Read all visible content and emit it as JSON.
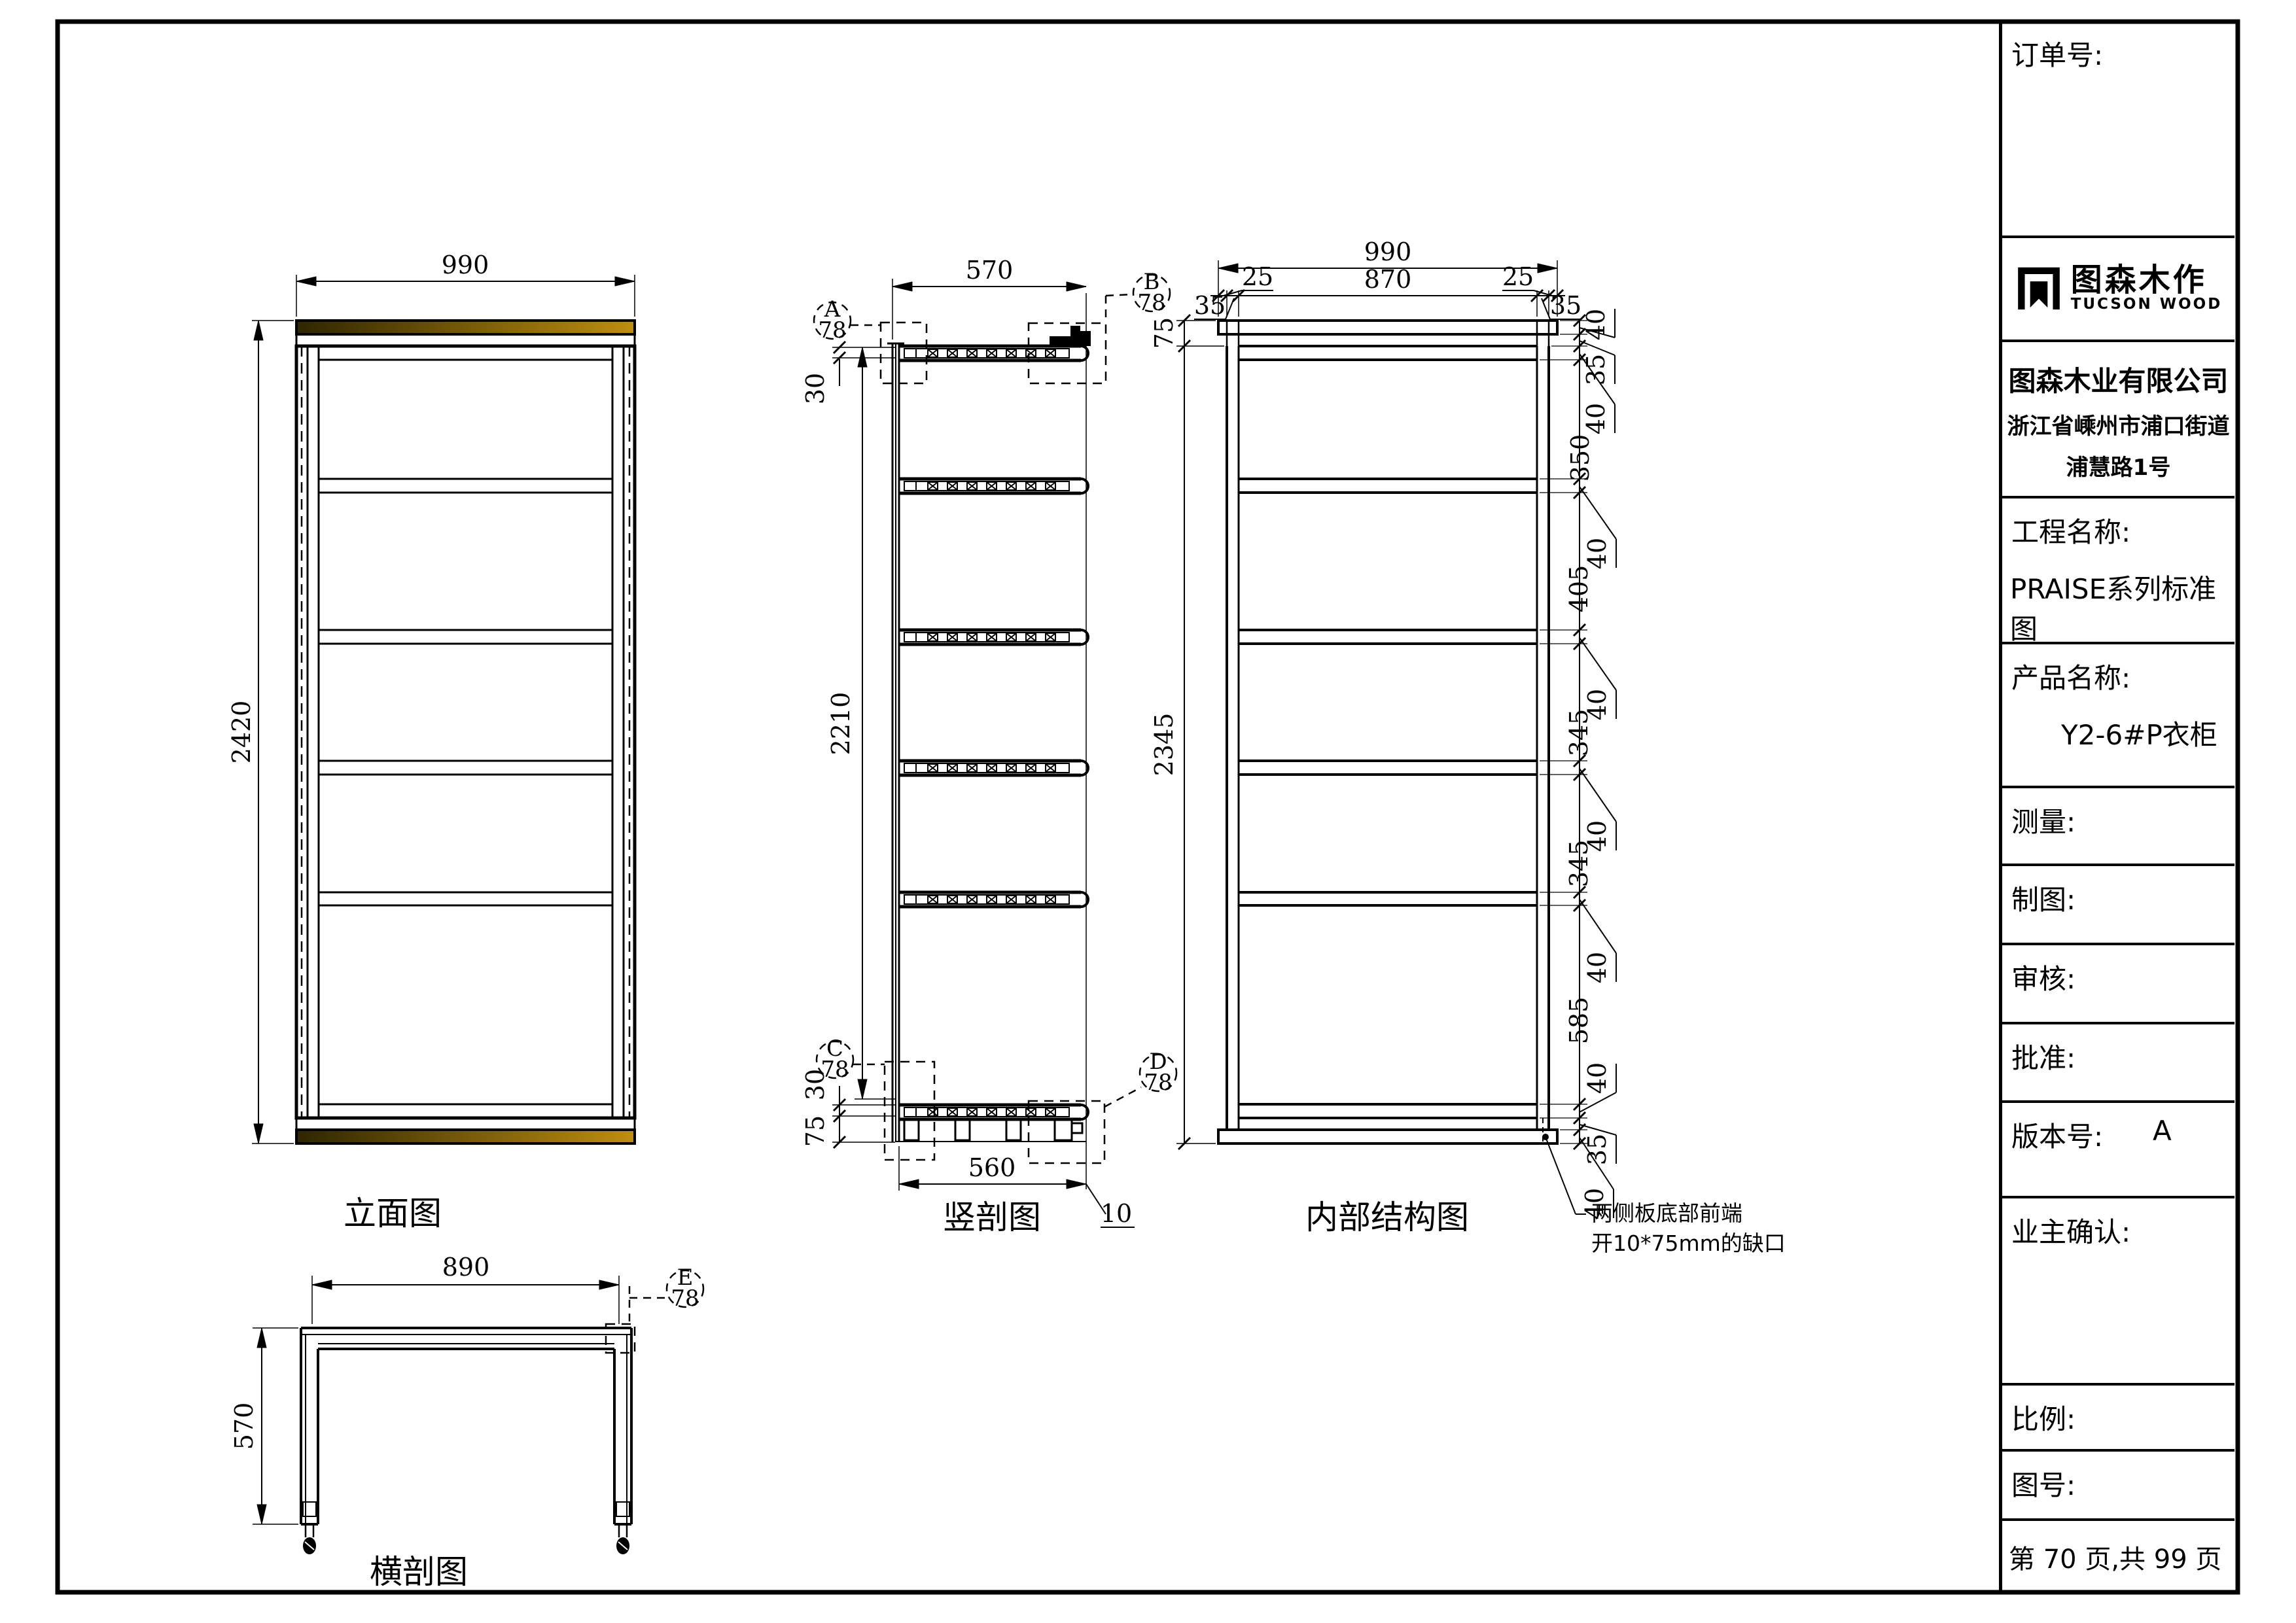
{
  "title_block": {
    "order_label": "订单号:",
    "logo_cn": "图森木作",
    "logo_en": "TUCSON WOOD",
    "company_name": "图森木业有限公司",
    "company_addr1": "浙江省嵊州市浦口街道",
    "company_addr2": "浦慧路1号",
    "project_label": "工程名称:",
    "project_value": "PRAISE系列标准图",
    "product_label": "产品名称:",
    "product_value": "Y2-6#P衣柜",
    "measure_label": "测量:",
    "draft_label": "制图:",
    "review_label": "审核:",
    "approve_label": "批准:",
    "version_label": "版本号:",
    "version_value": "A",
    "owner_label": "业主确认:",
    "scale_label": "比例:",
    "drawing_no_label": "图号:",
    "page_text": "第 70 页,共 99 页"
  },
  "views": {
    "detail_no": "78",
    "elevation": {
      "label": "立面图",
      "width": "990",
      "height": "2420"
    },
    "section": {
      "label": "竖剖图",
      "depth": "570",
      "height": "2210",
      "top_thickness": "30",
      "bottom_thickness": "30",
      "foot_height": "75",
      "bottom_depth": "560",
      "front_gap": "10",
      "callout_a": "A",
      "callout_b": "B",
      "callout_c": "C",
      "callout_d": "D"
    },
    "internal": {
      "label": "内部结构图",
      "total_width": "990",
      "inner_width": "870",
      "edge_left": "25",
      "edge_right": "25",
      "side_left": "35",
      "side_right": "35",
      "top_offset": "75",
      "body_height": "2345",
      "chain": [
        "40",
        "35",
        "40",
        "350",
        "40",
        "405",
        "40",
        "345",
        "40",
        "345",
        "40",
        "585",
        "40",
        "35",
        "40"
      ],
      "note1": "两侧板底部前端",
      "note2": "开10*75mm的缺口"
    },
    "plan": {
      "label": "横剖图",
      "width": "890",
      "depth": "570",
      "callout_e": "E"
    }
  },
  "colors": {
    "wood_dark": "#2f2600",
    "wood_gold": "#bd8e10",
    "line": "#000000"
  }
}
